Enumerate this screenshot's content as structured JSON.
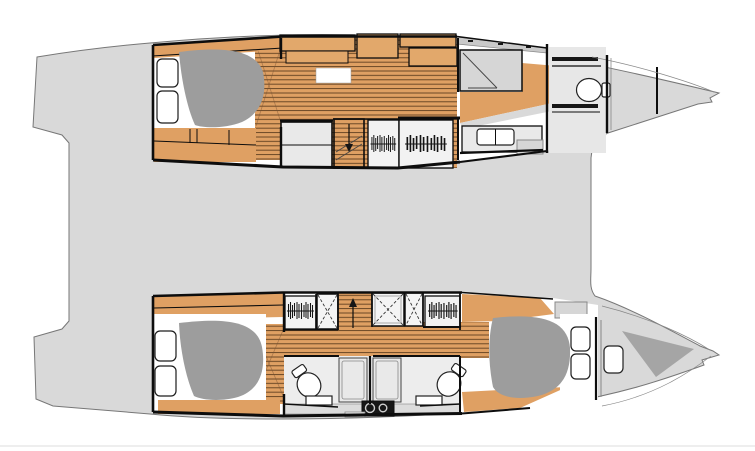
{
  "plan": {
    "vessel": "sailing-catamaran",
    "view": "interior-deck-plan-top-view",
    "bow_direction": "right",
    "hulls": [
      {
        "id": "upper-hull",
        "rooms": [
          "aft-double-cabin",
          "midship-dressing",
          "shower-room",
          "vanity-with-sink",
          "separate-toilet-room",
          "bow-locker"
        ],
        "features": [
          "double-berth",
          "two-pillows",
          "wood-plank-sole",
          "overhead-cabinets",
          "floor-hatch",
          "companionway-stairs-down",
          "storage-cabinet",
          "hanging-locker",
          "hanging-locker-wide",
          "sliding-door-track",
          "toilet",
          "shelves"
        ]
      },
      {
        "id": "lower-hull",
        "rooms": [
          "aft-double-cabin",
          "midship-corridor",
          "aft-bathroom",
          "forward-bathroom",
          "forward-double-cabin",
          "bow-locker"
        ],
        "features": [
          "double-berth-aft",
          "double-berth-forward",
          "two-pillows-each",
          "wood-plank-sole",
          "hanging-locker-port",
          "hanging-locker-stbd",
          "deck-hatch-x3",
          "companionway-stairs-up",
          "toilet-x2",
          "shower-stall-x2",
          "sink-x2",
          "technical-unit",
          "deck-step-hatch",
          "hull-window",
          "bow-shadow"
        ]
      }
    ],
    "deck_areas": [
      "aft-platform",
      "bridge-deck",
      "upper-bow-deck",
      "lower-bow-deck"
    ]
  },
  "colors": {
    "bg": "#ffffff",
    "deck": "#d9d9d9",
    "deckline": "#777777",
    "wall": "#0d0d0d",
    "wood": "#dfa063",
    "woodline": "#472c12",
    "cabinet": "#e2a86b",
    "gray1": "#e9e9e9",
    "gray2": "#d6d6d6",
    "gray3": "#c9c9c9",
    "mattress": "#9d9d9d",
    "shadow": "#a5a5a5",
    "white": "#ffffff",
    "dark": "#161616",
    "floorbath": "#ededed",
    "floorwc": "#e7e7e7",
    "ledge": "#dcdcdc",
    "hatchbg": "#f4f4f4",
    "wardrobebg": "#f2f2f2",
    "faint": "#e8e8e8"
  }
}
